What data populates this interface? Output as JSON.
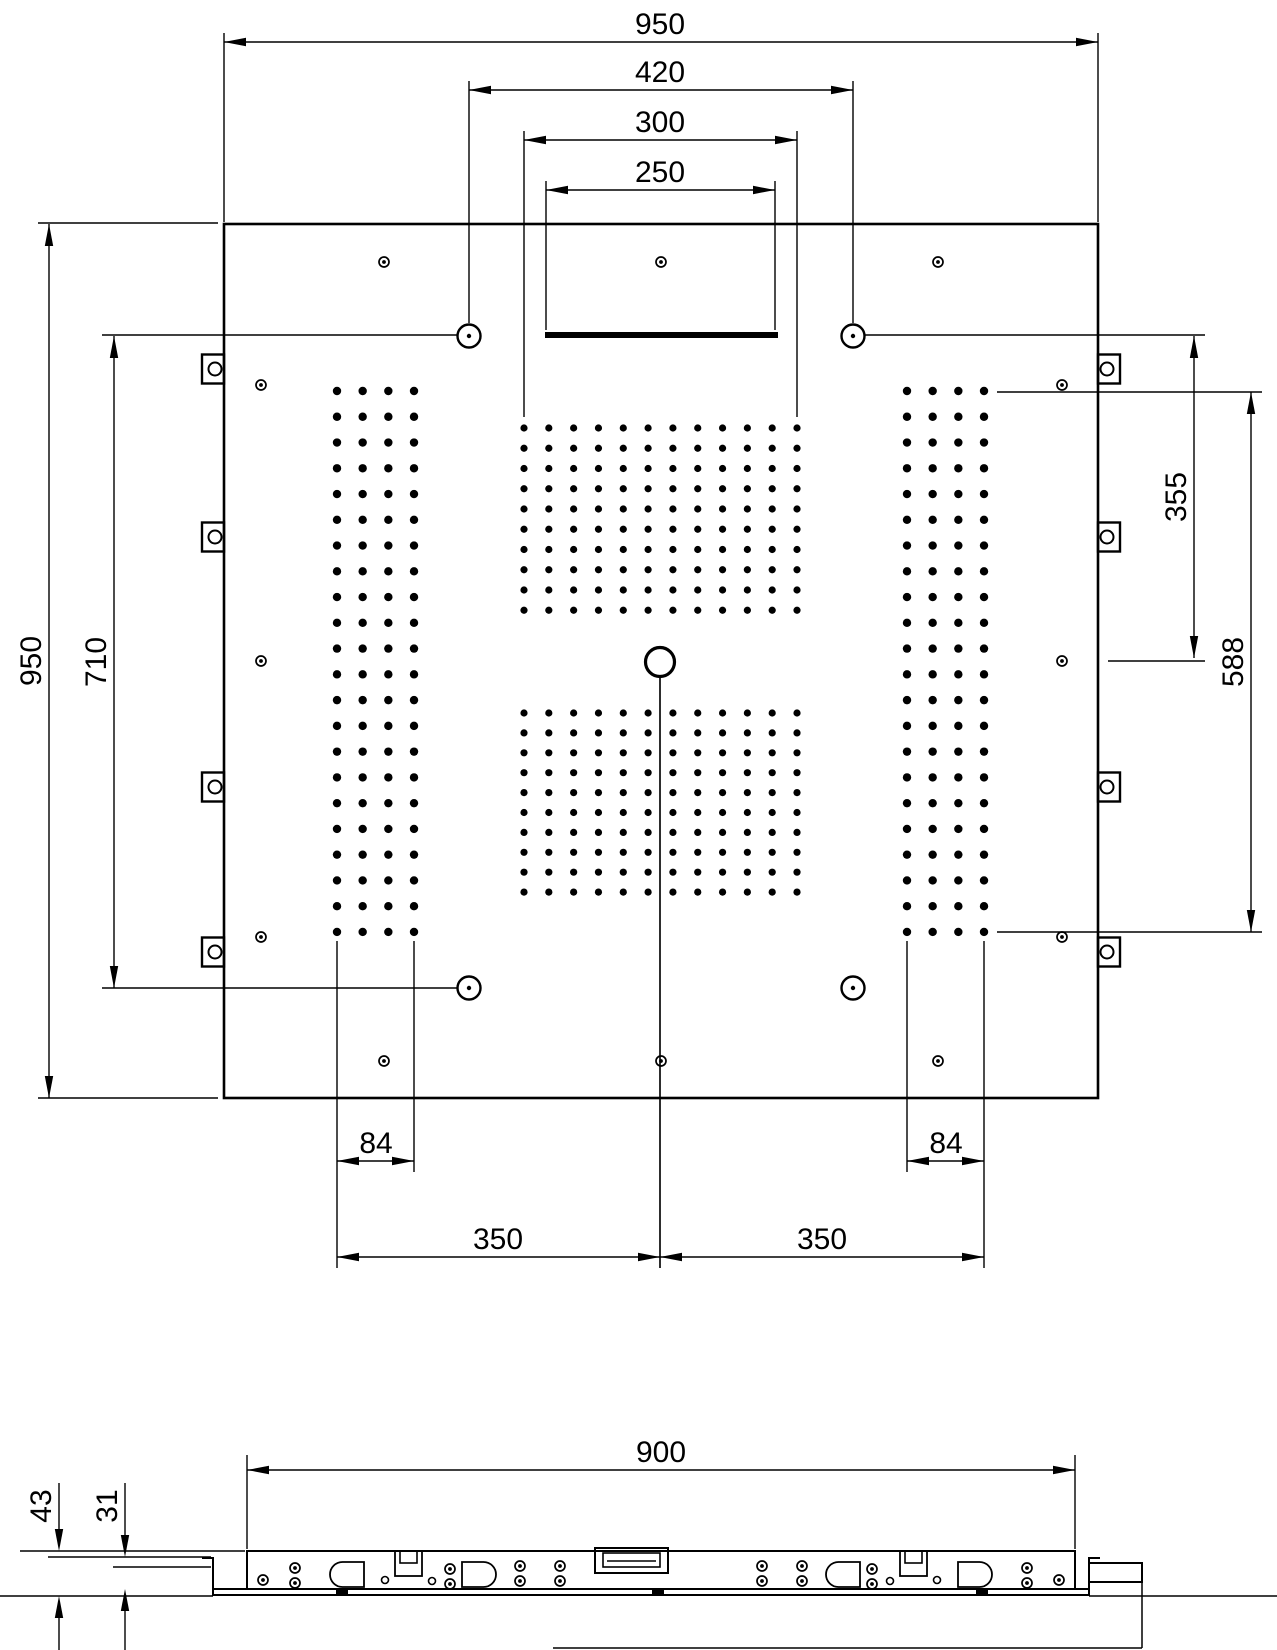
{
  "drawing": {
    "kind": "shower-ceiling-panel-installation-drawing",
    "ink_color": "#000000",
    "background": "#ffffff"
  },
  "dimensions": {
    "top": [
      {
        "id": "overall-width",
        "label": "950",
        "y": 42,
        "x1": 224,
        "x2": 1098
      },
      {
        "id": "circle-spacing",
        "label": "420",
        "y": 90,
        "x1": 469,
        "x2": 853
      },
      {
        "id": "spray-field-width",
        "label": "300",
        "y": 140,
        "x1": 524,
        "x2": 797
      },
      {
        "id": "slot-width",
        "label": "250",
        "y": 190,
        "x1": 546,
        "x2": 775
      }
    ],
    "left": [
      {
        "id": "overall-height",
        "label": "950",
        "x": 49,
        "y1": 224,
        "y2": 1098
      },
      {
        "id": "fix-hole-height",
        "label": "710",
        "x": 114,
        "y1": 336,
        "y2": 988
      }
    ],
    "right": [
      {
        "id": "edge-to-center",
        "label": "355",
        "x": 1194,
        "y1": 336,
        "y2": 658
      },
      {
        "id": "grid-height",
        "label": "588",
        "x": 1251,
        "y1": 392,
        "y2": 932
      }
    ],
    "bottom": [
      {
        "id": "strip-width-left",
        "label": "84",
        "y": 1161,
        "x1": 337,
        "x2": 414
      },
      {
        "id": "strip-width-right",
        "label": "84",
        "y": 1161,
        "x1": 907,
        "x2": 984
      },
      {
        "id": "strip-to-center-left",
        "label": "350",
        "y": 1257,
        "x1": 337,
        "x2": 660
      },
      {
        "id": "strip-to-center-right",
        "label": "350",
        "y": 1257,
        "x1": 660,
        "x2": 984
      }
    ],
    "side": [
      {
        "id": "housing-width",
        "label": "900",
        "type": "h",
        "y": 1470,
        "x1": 247,
        "x2": 1075
      },
      {
        "id": "total-depth",
        "label": "43",
        "type": "v-out",
        "x": 59,
        "y1": 1551,
        "y2": 1596,
        "stem_top": 1483,
        "stem_bot": 1650
      },
      {
        "id": "housing-depth",
        "label": "31",
        "type": "v-out",
        "x": 125,
        "y1": 1557,
        "y2": 1589,
        "stem_top": 1483,
        "stem_bot": 1650
      }
    ]
  },
  "panel": {
    "x": 224,
    "y": 224,
    "w": 874,
    "h": 874
  },
  "slot_bar": {
    "x": 545,
    "y": 332,
    "w": 233,
    "h": 6
  },
  "center_outlet": {
    "cx": 660,
    "cy": 662,
    "r": 14.5,
    "line_y2": 1268
  },
  "ring_circles": {
    "r": 11.5,
    "dot_r": 2.2,
    "positions": [
      [
        469,
        336
      ],
      [
        853,
        336
      ],
      [
        469,
        988
      ],
      [
        853,
        988
      ]
    ]
  },
  "screws": {
    "r": 5,
    "dot_r": 1.9,
    "positions": [
      [
        384,
        262
      ],
      [
        661,
        262
      ],
      [
        938,
        262
      ],
      [
        261,
        385
      ],
      [
        1062,
        385
      ],
      [
        261,
        661
      ],
      [
        1062,
        661
      ],
      [
        261,
        937
      ],
      [
        1062,
        937
      ],
      [
        384,
        1061
      ],
      [
        661,
        1061
      ],
      [
        938,
        1061
      ]
    ]
  },
  "mounting_tabs": {
    "w": 22,
    "h": 29,
    "left_x": 202,
    "right_x": 1098,
    "hole_r": 6.5,
    "left_hole_cx": 215,
    "right_hole_cx": 1107,
    "y_centers": [
      369,
      537,
      787,
      952
    ]
  },
  "nozzle_grids": [
    {
      "id": "left-strip",
      "x0": 337,
      "dx": 25.67,
      "cols": 4,
      "y0": 391,
      "dy": 25.76,
      "rows": 22,
      "dot_r": 4.2
    },
    {
      "id": "right-strip",
      "x0": 907,
      "dx": 25.67,
      "cols": 4,
      "y0": 391,
      "dy": 25.76,
      "rows": 22,
      "dot_r": 4.2
    },
    {
      "id": "center-upper",
      "x0": 524,
      "dx": 24.82,
      "cols": 12,
      "y0": 428,
      "dy": 20.25,
      "rows": 10,
      "dot_r": 3.6
    },
    {
      "id": "center-lower",
      "x0": 524,
      "dx": 24.82,
      "cols": 12,
      "y0": 713,
      "dy": 19.9,
      "rows": 10,
      "dot_r": 3.6
    }
  ],
  "ext_lines": [
    [
      38,
      223,
      218,
      223
    ],
    [
      38,
      1098,
      218,
      1098
    ],
    [
      224,
      33,
      224,
      222
    ],
    [
      1098,
      33,
      1098,
      222
    ],
    [
      469,
      81,
      469,
      323
    ],
    [
      853,
      81,
      853,
      323
    ],
    [
      524,
      131,
      524,
      417
    ],
    [
      797,
      131,
      797,
      417
    ],
    [
      546,
      181,
      546,
      330
    ],
    [
      775,
      181,
      775,
      330
    ],
    [
      102,
      335,
      457,
      335
    ],
    [
      865,
      335,
      1205,
      335
    ],
    [
      102,
      988,
      457,
      988
    ],
    [
      997,
      392,
      1262,
      392
    ],
    [
      997,
      932,
      1262,
      932
    ],
    [
      1108,
      661,
      1205,
      661
    ],
    [
      337,
      941,
      337,
      1268
    ],
    [
      414,
      941,
      414,
      1172
    ],
    [
      907,
      941,
      907,
      1172
    ],
    [
      984,
      941,
      984,
      1268
    ],
    [
      660,
      677,
      660,
      1268
    ],
    [
      247,
      1455,
      247,
      1549
    ],
    [
      1075,
      1455,
      1075,
      1549
    ],
    [
      20,
      1551,
      245,
      1551
    ],
    [
      48,
      1557,
      211,
      1557
    ],
    [
      113,
      1567,
      211,
      1567
    ],
    [
      0,
      1596,
      213,
      1596
    ],
    [
      1089,
      1596,
      1277,
      1596
    ]
  ],
  "side_view": {
    "housing": {
      "x": 247,
      "y": 1551,
      "w": 828,
      "h": 38
    },
    "plate": {
      "x": 213,
      "y": 1589,
      "w": 876,
      "h": 6
    },
    "hooks": [
      {
        "d": "M 202 1558 L 213 1558 L 213 1589"
      },
      {
        "d": "M 1100 1558 L 1089 1558 L 1089 1589"
      }
    ],
    "end_bracket": {
      "x": 1089,
      "y": 1563,
      "w": 53,
      "h": 19
    },
    "drop_lines": [
      [
        1142,
        1582,
        1142,
        1648
      ],
      [
        553,
        1648,
        1142,
        1648
      ]
    ],
    "screws": [
      [
        263,
        1580
      ],
      [
        295,
        1568
      ],
      [
        295,
        1583
      ],
      [
        450,
        1569
      ],
      [
        450,
        1584
      ],
      [
        520,
        1566
      ],
      [
        520,
        1581
      ],
      [
        560,
        1566
      ],
      [
        560,
        1581
      ],
      [
        762,
        1566
      ],
      [
        762,
        1581
      ],
      [
        802,
        1566
      ],
      [
        802,
        1581
      ],
      [
        872,
        1569
      ],
      [
        872,
        1584
      ],
      [
        1027,
        1568
      ],
      [
        1027,
        1583
      ],
      [
        1059,
        1580
      ]
    ],
    "small_holes": [
      [
        385,
        1580
      ],
      [
        432,
        1581
      ],
      [
        890,
        1581
      ],
      [
        937,
        1580
      ]
    ],
    "d_slots": [
      {
        "x": 330,
        "y": 1562,
        "w": 34,
        "h": 25,
        "round": "left"
      },
      {
        "x": 462,
        "y": 1562,
        "w": 34,
        "h": 25,
        "round": "right"
      },
      {
        "x": 826,
        "y": 1562,
        "w": 34,
        "h": 25,
        "round": "left"
      },
      {
        "x": 958,
        "y": 1562,
        "w": 34,
        "h": 25,
        "round": "right"
      }
    ],
    "clamps": [
      {
        "x": 395,
        "y": 1551,
        "w": 27,
        "h": 25,
        "ix": 400,
        "iw": 17,
        "ih": 12
      },
      {
        "x": 900,
        "y": 1551,
        "w": 27,
        "h": 25,
        "ix": 905,
        "iw": 17,
        "ih": 12
      }
    ],
    "inlet": {
      "x": 595,
      "y": 1548,
      "w": 73,
      "h": 25,
      "inner": {
        "x": 603,
        "y": 1553,
        "w": 57,
        "h": 14
      },
      "line": [
        607,
        1561,
        656,
        1561
      ]
    },
    "feet": [
      [
        336,
        1589,
        12,
        5
      ],
      [
        652,
        1589,
        12,
        5
      ],
      [
        976,
        1589,
        12,
        5
      ]
    ]
  }
}
